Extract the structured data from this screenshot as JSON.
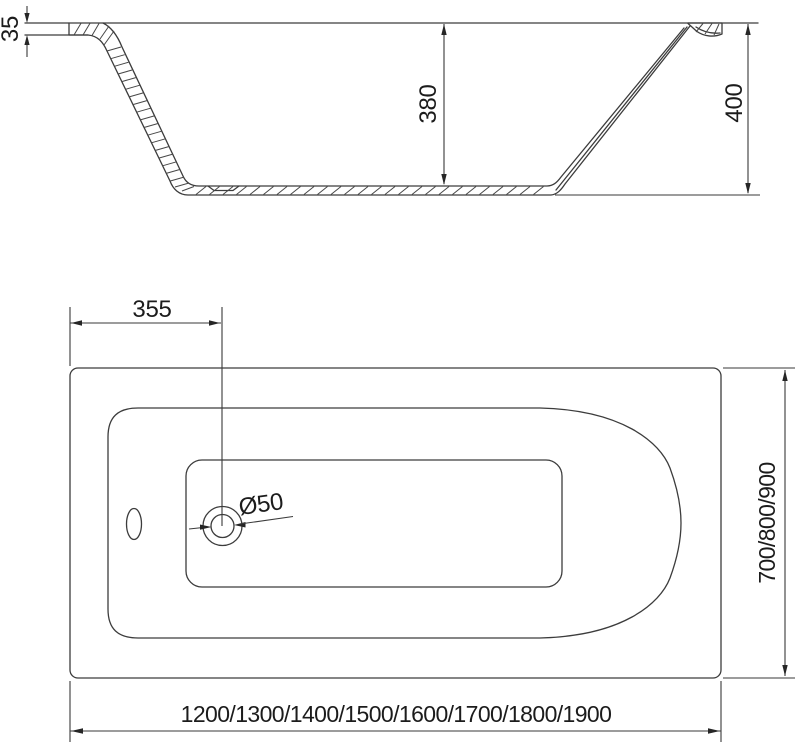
{
  "drawing": {
    "subject": "bathtub-technical-drawing",
    "background_color": "#ffffff",
    "line_color": "#3c3c3c",
    "text_color": "#1c1c1c",
    "section_view": {
      "rim_thickness_label": "35",
      "inner_depth_label": "380",
      "overall_height_label": "400"
    },
    "plan_view": {
      "drain_offset_label": "355",
      "drain_diameter_label": "Ø50",
      "width_options_label": "700/800/900",
      "length_options_label": "1200/1300/1400/1500/1600/1700/1800/1900"
    }
  }
}
